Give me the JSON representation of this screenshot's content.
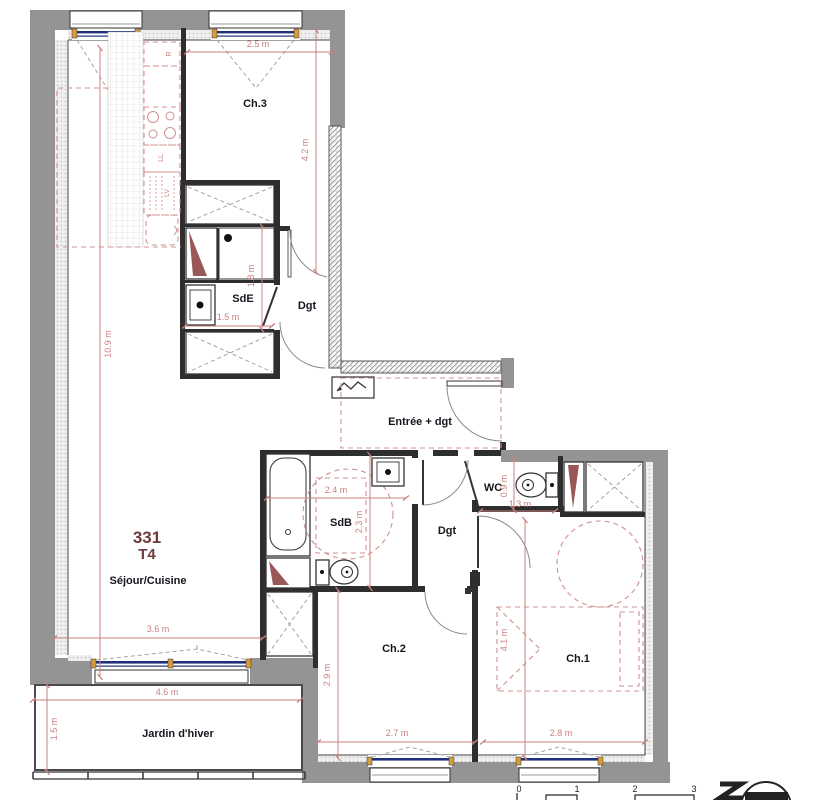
{
  "plan": {
    "unit_number": "331",
    "unit_type": "T4",
    "rooms": [
      {
        "id": "ch3",
        "label": "Ch.3"
      },
      {
        "id": "sde",
        "label": "SdE"
      },
      {
        "id": "dgt-upper",
        "label": "Dgt"
      },
      {
        "id": "entree",
        "label": "Entrée + dgt"
      },
      {
        "id": "wc",
        "label": "WC"
      },
      {
        "id": "sdb",
        "label": "SdB"
      },
      {
        "id": "dgt-lower",
        "label": "Dgt"
      },
      {
        "id": "sejour",
        "label": "Séjour/Cuisine"
      },
      {
        "id": "ch2",
        "label": "Ch.2"
      },
      {
        "id": "ch1",
        "label": "Ch.1"
      },
      {
        "id": "jardin",
        "label": "Jardin d'hiver"
      }
    ],
    "dimensions": [
      {
        "text": "2.5 m"
      },
      {
        "text": "4.2 m"
      },
      {
        "text": "10.9 m"
      },
      {
        "text": "1.8 m"
      },
      {
        "text": "1.5 m"
      },
      {
        "text": "2.4 m"
      },
      {
        "text": "2.3 m"
      },
      {
        "text": "0.9 m"
      },
      {
        "text": "1.3 m"
      },
      {
        "text": "3.6 m"
      },
      {
        "text": "4.6 m"
      },
      {
        "text": "1.5 m"
      },
      {
        "text": "2.9 m"
      },
      {
        "text": "2.7 m"
      },
      {
        "text": "4.1 m"
      },
      {
        "text": "2.8 m"
      }
    ],
    "kitchen_appliances": [
      {
        "label": "R"
      },
      {
        "label": "LL"
      },
      {
        "label": "LV"
      }
    ],
    "scale_bar": {
      "ticks": [
        "0",
        "1",
        "2",
        "3"
      ]
    },
    "colors": {
      "wall_gray": "#949494",
      "wall_dark": "#2e2e2e",
      "dimension_red": "#c8807f",
      "furniture_red": "#d09090",
      "window_blue": "#22307a",
      "frame_orange": "#d79b3c",
      "fixture_wedge": "#9a5757",
      "unit_label": "#6e3a3a"
    }
  }
}
